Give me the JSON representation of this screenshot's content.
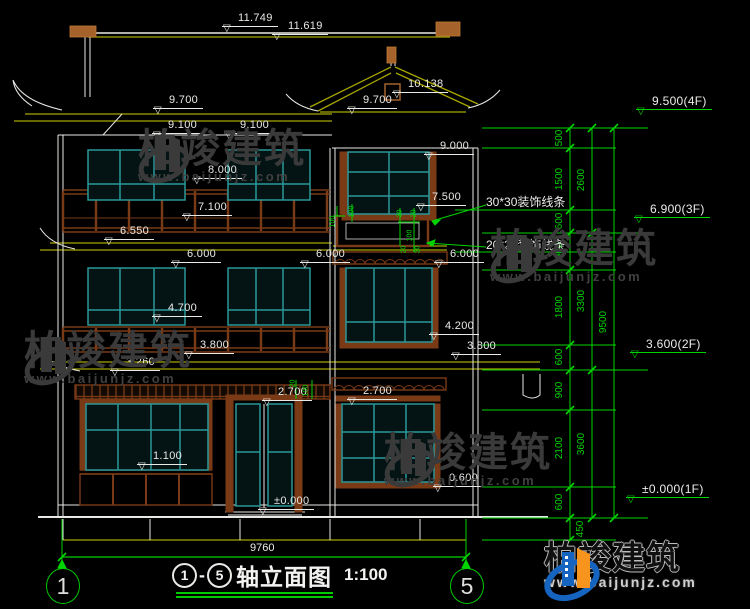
{
  "title": {
    "axis_from": "1",
    "axis_to": "5",
    "dash": "-",
    "name": "轴立面图",
    "scale": "1:100"
  },
  "axis_bubbles": {
    "left": "1",
    "right": "5"
  },
  "bottom_dim": "9760",
  "annotations": {
    "deco30": "30*30装饰线条",
    "deco20": "20*20装饰线条"
  },
  "watermark": {
    "name": "柏竣建筑",
    "url": "www.baijunjz.com"
  },
  "colors": {
    "dim_green": "#00d400",
    "roof_yellow": "#a6a600",
    "wood_brown": "#7a3a16",
    "window_teal": "#2b9898",
    "line_white": "#e9e9e6",
    "brand_blue": "#1565c0",
    "brand_orange": "#f7941e"
  },
  "elevation_markers": [
    {
      "label": "11.749",
      "x": 222,
      "y": 12,
      "green": false
    },
    {
      "label": "11.619",
      "x": 272,
      "y": 20,
      "green": false
    },
    {
      "label": "10.138",
      "x": 392,
      "y": 78,
      "green": false
    },
    {
      "label": "9.700",
      "x": 153,
      "y": 94,
      "green": false
    },
    {
      "label": "9.700",
      "x": 347,
      "y": 94,
      "green": false
    },
    {
      "label": "9.100",
      "x": 152,
      "y": 119,
      "green": false
    },
    {
      "label": "9.100",
      "x": 224,
      "y": 119,
      "green": false
    },
    {
      "label": "9.000",
      "x": 424,
      "y": 140,
      "green": false
    },
    {
      "label": "8.000",
      "x": 192,
      "y": 164,
      "green": false
    },
    {
      "label": "7.500",
      "x": 416,
      "y": 191,
      "green": false
    },
    {
      "label": "7.100",
      "x": 182,
      "y": 201,
      "green": false
    },
    {
      "label": "6.550",
      "x": 104,
      "y": 225,
      "green": false
    },
    {
      "label": "6.000",
      "x": 171,
      "y": 248,
      "green": false
    },
    {
      "label": "6.000",
      "x": 300,
      "y": 248,
      "green": false
    },
    {
      "label": "6.000",
      "x": 434,
      "y": 248,
      "green": false
    },
    {
      "label": "4.700",
      "x": 152,
      "y": 302,
      "green": false
    },
    {
      "label": "4.200",
      "x": 429,
      "y": 320,
      "green": false
    },
    {
      "label": "3.800",
      "x": 184,
      "y": 339,
      "green": false
    },
    {
      "label": "3.800",
      "x": 451,
      "y": 340,
      "green": false
    },
    {
      "label": "3.260",
      "x": 110,
      "y": 356,
      "green": false
    },
    {
      "label": "2.700",
      "x": 262,
      "y": 386,
      "green": false
    },
    {
      "label": "2.700",
      "x": 347,
      "y": 385,
      "green": false
    },
    {
      "label": "1.100",
      "x": 137,
      "y": 450,
      "green": false
    },
    {
      "label": "0.600",
      "x": 433,
      "y": 472,
      "green": false
    },
    {
      "label": "±0.000",
      "x": 258,
      "y": 495,
      "green": false
    },
    {
      "label": "9.500(4F)",
      "x": 636,
      "y": 95,
      "green": true
    },
    {
      "label": "6.900(3F)",
      "x": 634,
      "y": 203,
      "green": true
    },
    {
      "label": "3.600(2F)",
      "x": 630,
      "y": 338,
      "green": true
    },
    {
      "label": "±0.000(1F)",
      "x": 626,
      "y": 483,
      "green": true
    }
  ],
  "chain_dims": [
    {
      "label": "500",
      "cx": 560,
      "cy": 138
    },
    {
      "label": "1500",
      "cx": 560,
      "cy": 179
    },
    {
      "label": "600",
      "cx": 560,
      "cy": 221
    },
    {
      "label": "900",
      "cx": 560,
      "cy": 251
    },
    {
      "label": "1800",
      "cx": 560,
      "cy": 307
    },
    {
      "label": "600",
      "cx": 560,
      "cy": 357
    },
    {
      "label": "900",
      "cx": 560,
      "cy": 390
    },
    {
      "label": "2100",
      "cx": 560,
      "cy": 448
    },
    {
      "label": "600",
      "cx": 560,
      "cy": 502
    },
    {
      "label": "450",
      "cx": 581,
      "cy": 529
    },
    {
      "label": "2600",
      "cx": 582,
      "cy": 180
    },
    {
      "label": "3300",
      "cx": 582,
      "cy": 301
    },
    {
      "label": "3600",
      "cx": 582,
      "cy": 444
    },
    {
      "label": "9500",
      "cx": 604,
      "cy": 322
    }
  ],
  "small_dims": [
    {
      "label": "100",
      "cx": 352,
      "cy": 212
    },
    {
      "label": "100",
      "cx": 333,
      "cy": 222
    },
    {
      "label": "30",
      "cx": 400,
      "cy": 214
    },
    {
      "label": "20",
      "cx": 414,
      "cy": 214
    },
    {
      "label": "100",
      "cx": 410,
      "cy": 236
    },
    {
      "label": "30",
      "cx": 418,
      "cy": 250
    },
    {
      "label": "20",
      "cx": 404,
      "cy": 250
    },
    {
      "label": "20",
      "cx": 293,
      "cy": 384
    },
    {
      "label": "100",
      "cx": 306,
      "cy": 391
    }
  ]
}
